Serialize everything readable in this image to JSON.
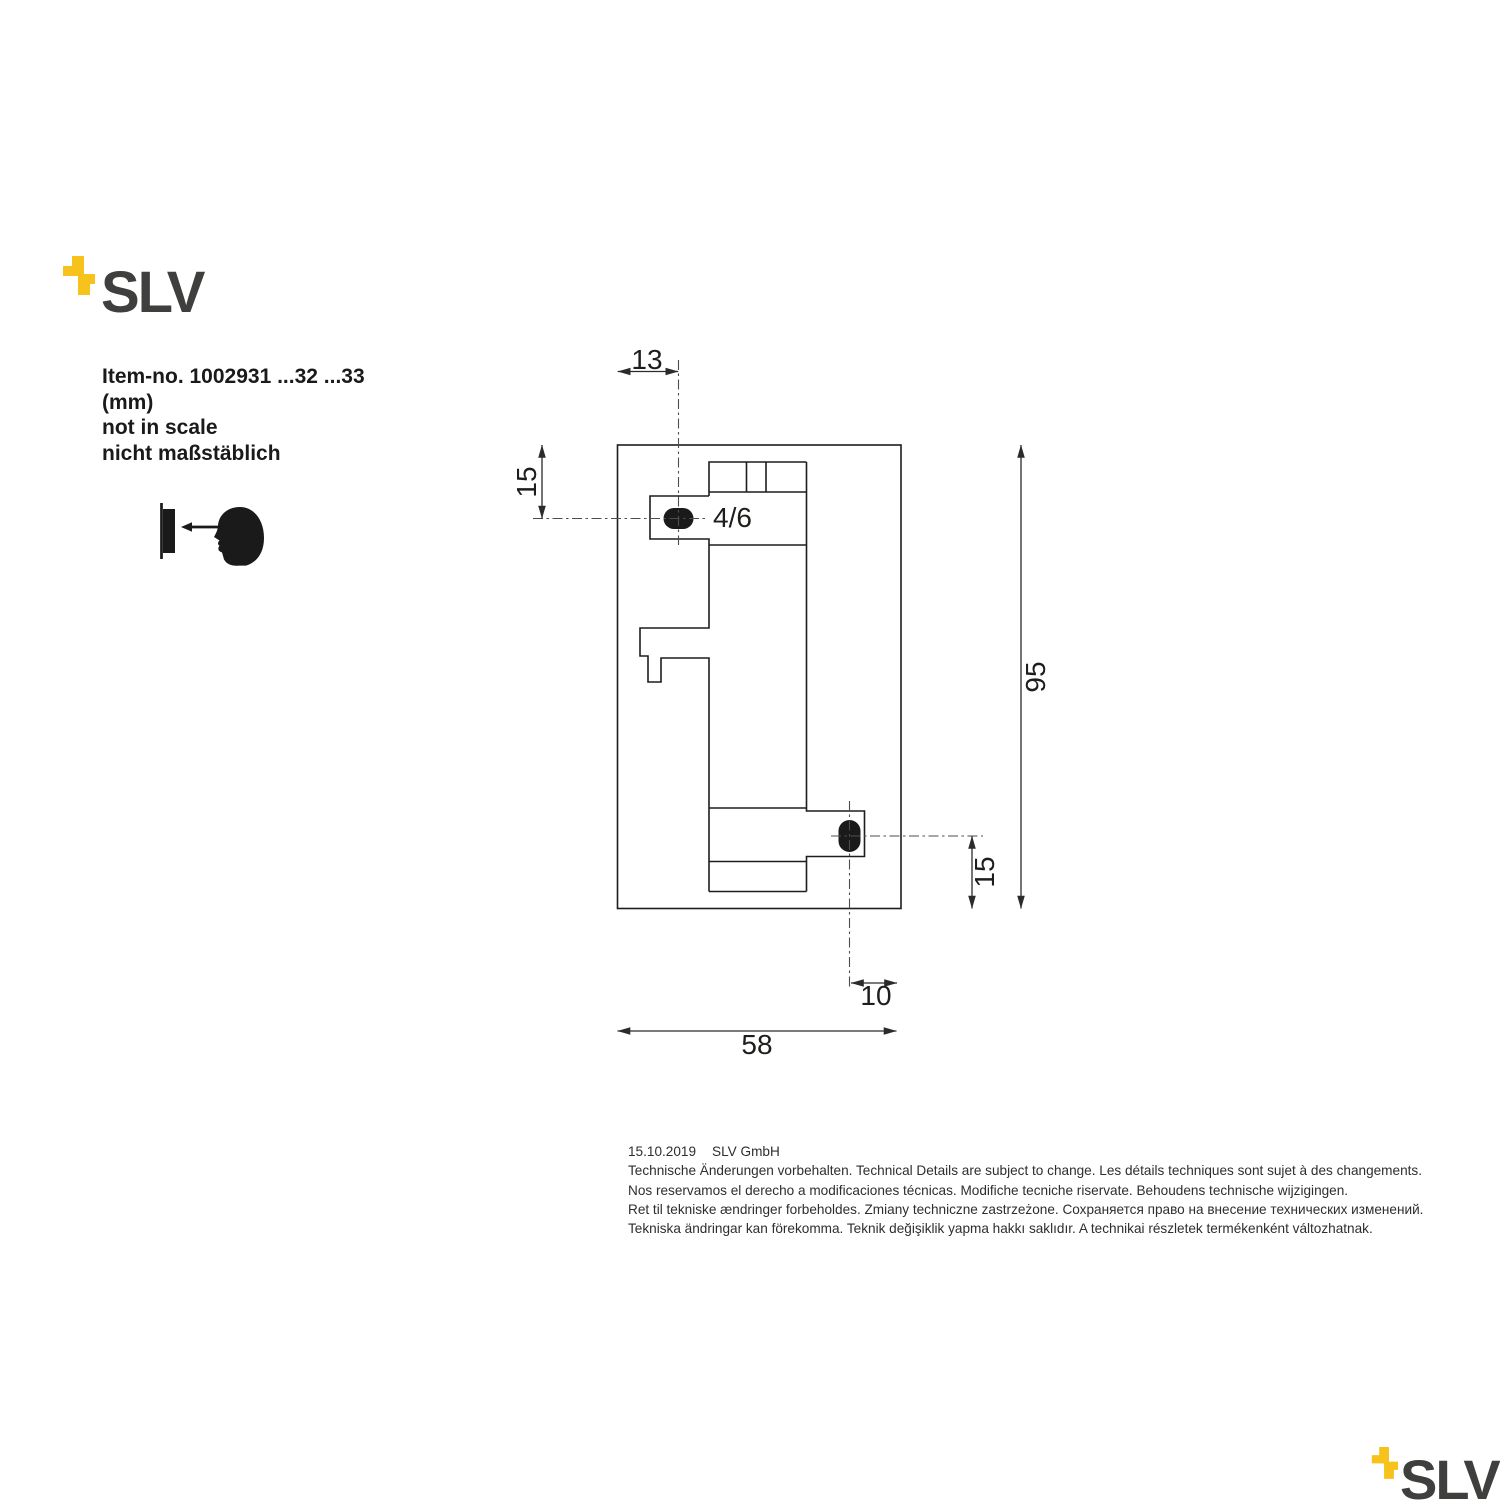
{
  "brand": {
    "name": "SLV",
    "yellow": "#F8C21C",
    "gray": "#3F3F3E"
  },
  "item_info": {
    "item_no": "Item-no. 1002931 ...32 ...33",
    "unit": "(mm)",
    "scale_en": "not in scale",
    "scale_de": "nicht maßstäblich"
  },
  "drawing": {
    "dim_top_offset": "13",
    "dim_top_hole_depth": "15",
    "dim_overall_height": "95",
    "dim_bottom_hole_depth": "15",
    "dim_bottom_offset": "10",
    "dim_overall_width": "58",
    "hole_label": "4/6"
  },
  "footer": {
    "date": "15.10.2019",
    "company": "SLV GmbH",
    "lines": [
      "Technische Änderungen vorbehalten. Technical Details are subject to change. Les détails techniques sont sujet à des changements.",
      "Nos reservamos el derecho a modificaciones técnicas. Modifiche tecniche riservate. Behoudens technische wijzigingen.",
      "Ret til tekniske ændringer forbeholdes. Zmiany techniczne zastrzeżone. Сохраняется право на внесение технических изменений.",
      "Tekniska ändringar kan förekomma. Teknik değişiklik yapma hakkı saklıdır. A technikai részletek termékenként változhatnak."
    ]
  }
}
